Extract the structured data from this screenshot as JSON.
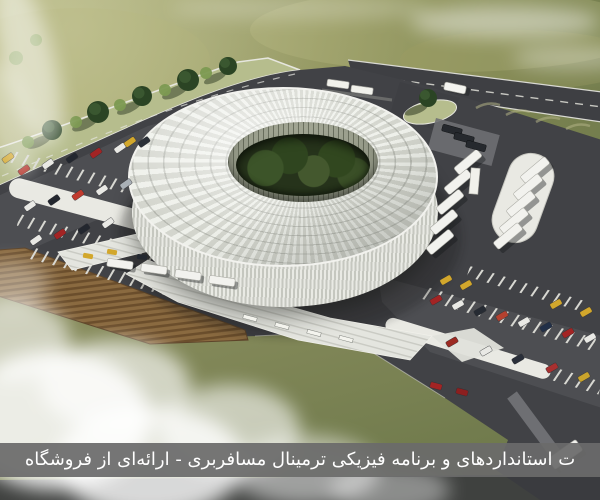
{
  "image": {
    "type": "architectural-aerial-render",
    "subject": "Aerial 3D rendering of a circular passenger terminal building with a ribbed ring roof and central tree courtyard, surrounded by roads, bus bays, car parking lots, a plowed field and drifting fog"
  },
  "banner": {
    "text": "ت استانداردهای و برنامه فیزیکی ترمینال مسافربری - ارائه‌ای از فروشگاه",
    "background": "#6a6a6a",
    "text_color": "#ffffff"
  },
  "palette": {
    "grass": "#8d9159",
    "asphalt": "#414246",
    "parking_surface": "#55565a",
    "roof_white": "#e9eae4",
    "drum_rib": "#c5c7bf",
    "courtyard_green": "#26331b",
    "field_brown": "#8a6a40",
    "furrow_brown": "#6b4e2c",
    "median_white": "#e9e9e3",
    "tree_green": "#2b4424",
    "taxi_yellow": "#d2a72c",
    "car_red": "#a32424",
    "fog_white": "#ffffff"
  },
  "scene": {
    "elements": [
      "terminal-building",
      "ring-roof",
      "central-courtyard",
      "ring-road",
      "tree-lined-median",
      "left-car-parking",
      "right-car-parking",
      "bus-parking-oval",
      "bus-dock-platform",
      "entrance-plaza-steps",
      "plowed-field",
      "grass-terrain",
      "fog-clouds",
      "buses",
      "cars",
      "taxis"
    ]
  }
}
